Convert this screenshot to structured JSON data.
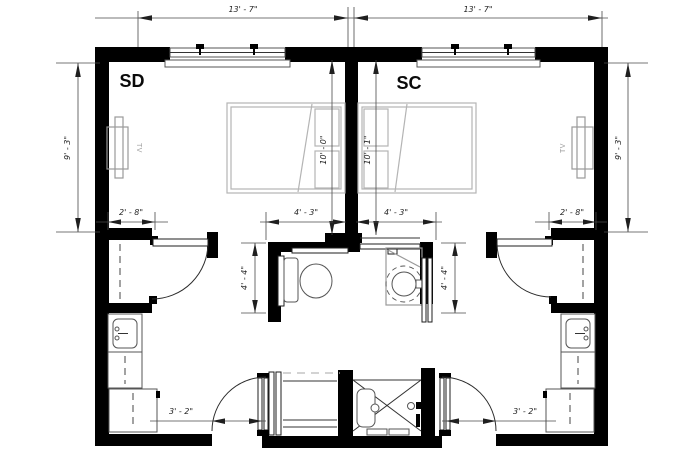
{
  "drawing": {
    "rooms": [
      {
        "label": "SD"
      },
      {
        "label": "SC"
      }
    ],
    "tv_label": "TV",
    "fixture_names": [
      "bed",
      "tv",
      "toilet",
      "grab-bars",
      "vanity-sink",
      "round-sink",
      "pocket-door",
      "sliding-door",
      "shower",
      "closet",
      "kitchenette-sink",
      "counter",
      "refrigerator"
    ]
  },
  "dims": {
    "top_left": "13' - 7\"",
    "top_right": "13' - 7\"",
    "side_left": "9' - 3\"",
    "side_right": "9' - 3\"",
    "sd_depth": "10' - 0\"",
    "sc_depth": "10' - 1\"",
    "sd_closet": "2' - 8\"",
    "sd_bath": "4' - 3\"",
    "sc_bath": "4' - 3\"",
    "sc_closet": "2' - 8\"",
    "bath_left": "4' - 4\"",
    "bath_right": "4' - 4\"",
    "sd_entry": "3' - 2\"",
    "sc_entry": "3' - 2\""
  },
  "colors": {
    "wall": "#000000",
    "furniture": "#9a9a9a",
    "bed": "#b4b4b4",
    "dimension": "#1f1f1f",
    "background": "#ffffff"
  }
}
